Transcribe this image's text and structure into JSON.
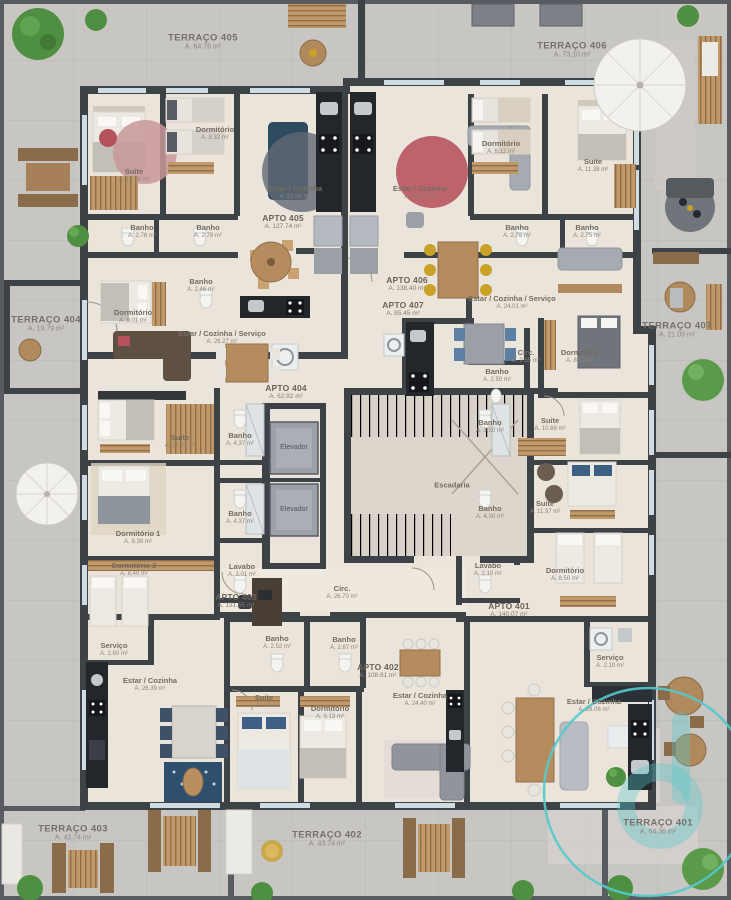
{
  "plan": {
    "terraces": [
      {
        "name": "TERRAÇO 405",
        "area": "A. 64.76 m²",
        "x": 203,
        "y": 42
      },
      {
        "name": "TERRAÇO 406",
        "area": "A. 73.10 m²",
        "x": 572,
        "y": 50
      },
      {
        "name": "TERRAÇO 404",
        "area": "A. 19.79 m²",
        "x": 46,
        "y": 324
      },
      {
        "name": "TERRAÇO 407",
        "area": "A. 21.09 m²",
        "x": 677,
        "y": 330
      },
      {
        "name": "TERRAÇO 403",
        "area": "A. 43.74 m²",
        "x": 73,
        "y": 833
      },
      {
        "name": "TERRAÇO 402",
        "area": "A. 43.74 m²",
        "x": 327,
        "y": 839
      },
      {
        "name": "TERRAÇO 401",
        "area": "A. 64.36 m²",
        "x": 658,
        "y": 827
      }
    ],
    "apartments": [
      {
        "name": "APTO 405",
        "area": "A. 127.74 m²",
        "x": 283,
        "y": 222
      },
      {
        "name": "APTO 406",
        "area": "A. 138.40 m²",
        "x": 407,
        "y": 284
      },
      {
        "name": "APTO 407",
        "area": "A. 85.45 m²",
        "x": 403,
        "y": 309
      },
      {
        "name": "APTO 404",
        "area": "A. 62.92 m²",
        "x": 286,
        "y": 392
      },
      {
        "name": "APTO 403",
        "area": "A. 131.55 m²",
        "x": 236,
        "y": 601
      },
      {
        "name": "APTO 402",
        "area": "A. 108.81 m²",
        "x": 378,
        "y": 671
      },
      {
        "name": "APTO 401",
        "area": "A. 140.07 m²",
        "x": 509,
        "y": 610
      }
    ],
    "rooms": [
      {
        "name": "Suite",
        "area": "A. 12.16 m²",
        "x": 134,
        "y": 176
      },
      {
        "name": "Dormitório",
        "area": "A. 8.32 m²",
        "x": 215,
        "y": 134
      },
      {
        "name": "Banho",
        "area": "A. 2.76 m²",
        "x": 142,
        "y": 232
      },
      {
        "name": "Banho",
        "area": "A. 2.78 m²",
        "x": 208,
        "y": 232
      },
      {
        "name": "Estar / Cozinha",
        "area": "A. 22.58 m²",
        "x": 295,
        "y": 193
      },
      {
        "name": "Estar / Cozinha",
        "area": "A. 23.30 m²",
        "x": 420,
        "y": 193
      },
      {
        "name": "Dormitório",
        "area": "A. 8.12 m²",
        "x": 501,
        "y": 148
      },
      {
        "name": "Suite",
        "area": "A. 11.38 m²",
        "x": 593,
        "y": 166
      },
      {
        "name": "Banho",
        "area": "A. 2.76 m²",
        "x": 517,
        "y": 232
      },
      {
        "name": "Banho",
        "area": "A. 2.75 m²",
        "x": 587,
        "y": 232
      },
      {
        "name": "Banho",
        "area": "A. 2.46 m²",
        "x": 201,
        "y": 286
      },
      {
        "name": "Dormitório",
        "area": "A. 9.01 m²",
        "x": 133,
        "y": 317
      },
      {
        "name": "Estar / Cozinha / Serviço",
        "area": "A. 26.27 m²",
        "x": 222,
        "y": 338
      },
      {
        "name": "Estar / Cozinha / Serviço",
        "area": "A. 24.01 m²",
        "x": 512,
        "y": 303
      },
      {
        "name": "Circ.",
        "area": "A. 2.55 m²",
        "x": 526,
        "y": 357
      },
      {
        "name": "Banho",
        "area": "A. 2.50 m²",
        "x": 497,
        "y": 376
      },
      {
        "name": "Dormitório",
        "area": "A. 8.50 m²",
        "x": 580,
        "y": 357
      },
      {
        "name": "Suite",
        "area": "A. 11.72 m²",
        "x": 180,
        "y": 442
      },
      {
        "name": "Banho",
        "area": "A. 4.37 m²",
        "x": 240,
        "y": 440
      },
      {
        "name": "Banho",
        "area": "A. 4.37 m²",
        "x": 240,
        "y": 518
      },
      {
        "name": "Dormitório 1",
        "area": "A. 8.38 m²",
        "x": 138,
        "y": 538
      },
      {
        "name": "Dormitório 2",
        "area": "A. 8.49 m²",
        "x": 134,
        "y": 570
      },
      {
        "name": "Lavabo",
        "area": "A. 2.01 m²",
        "x": 242,
        "y": 571
      },
      {
        "name": "Serviço",
        "area": "A. 2.80 m²",
        "x": 114,
        "y": 650
      },
      {
        "name": "Estar / Cozinha",
        "area": "A. 26.39 m²",
        "x": 150,
        "y": 685
      },
      {
        "name": "Banho",
        "area": "A. 2.52 m²",
        "x": 277,
        "y": 643
      },
      {
        "name": "Banho",
        "area": "A. 2.87 m²",
        "x": 344,
        "y": 644
      },
      {
        "name": "Suite",
        "area": "A. 11.80 m²",
        "x": 264,
        "y": 702
      },
      {
        "name": "Dormitório",
        "area": "A. 9.13 m²",
        "x": 330,
        "y": 713
      },
      {
        "name": "Estar / Cozinha",
        "area": "A. 24.40 m²",
        "x": 420,
        "y": 700
      },
      {
        "name": "Banho",
        "area": "A. 3.50 m²",
        "x": 490,
        "y": 427
      },
      {
        "name": "Suite",
        "area": "A. 10.68 m²",
        "x": 550,
        "y": 425
      },
      {
        "name": "Banho",
        "area": "A. 4.30 m²",
        "x": 490,
        "y": 513
      },
      {
        "name": "Suite",
        "area": "A. 11.97 m²",
        "x": 545,
        "y": 508
      },
      {
        "name": "Lavabo",
        "area": "A. 2.10 m²",
        "x": 488,
        "y": 570
      },
      {
        "name": "Dormitório",
        "area": "A. 8.50 m²",
        "x": 565,
        "y": 575
      },
      {
        "name": "Serviço",
        "area": "A. 2.10 m²",
        "x": 610,
        "y": 662
      },
      {
        "name": "Estar / Cozinha",
        "area": "A. 28.06 m²",
        "x": 594,
        "y": 706
      }
    ],
    "core": [
      {
        "name": "Elevador",
        "x": 294,
        "y": 448
      },
      {
        "name": "Elevador",
        "x": 294,
        "y": 510
      },
      {
        "name": "Escadaria",
        "x": 452,
        "y": 486
      },
      {
        "name": "Circ.",
        "area": "A. 26.70 m²",
        "x": 342,
        "y": 593
      }
    ]
  },
  "colors": {
    "wall": "#3d4247",
    "floor": "#eae4db",
    "outdoor": "#c8c6c2",
    "watermark": "#54c9cc",
    "label": "#746c61"
  }
}
